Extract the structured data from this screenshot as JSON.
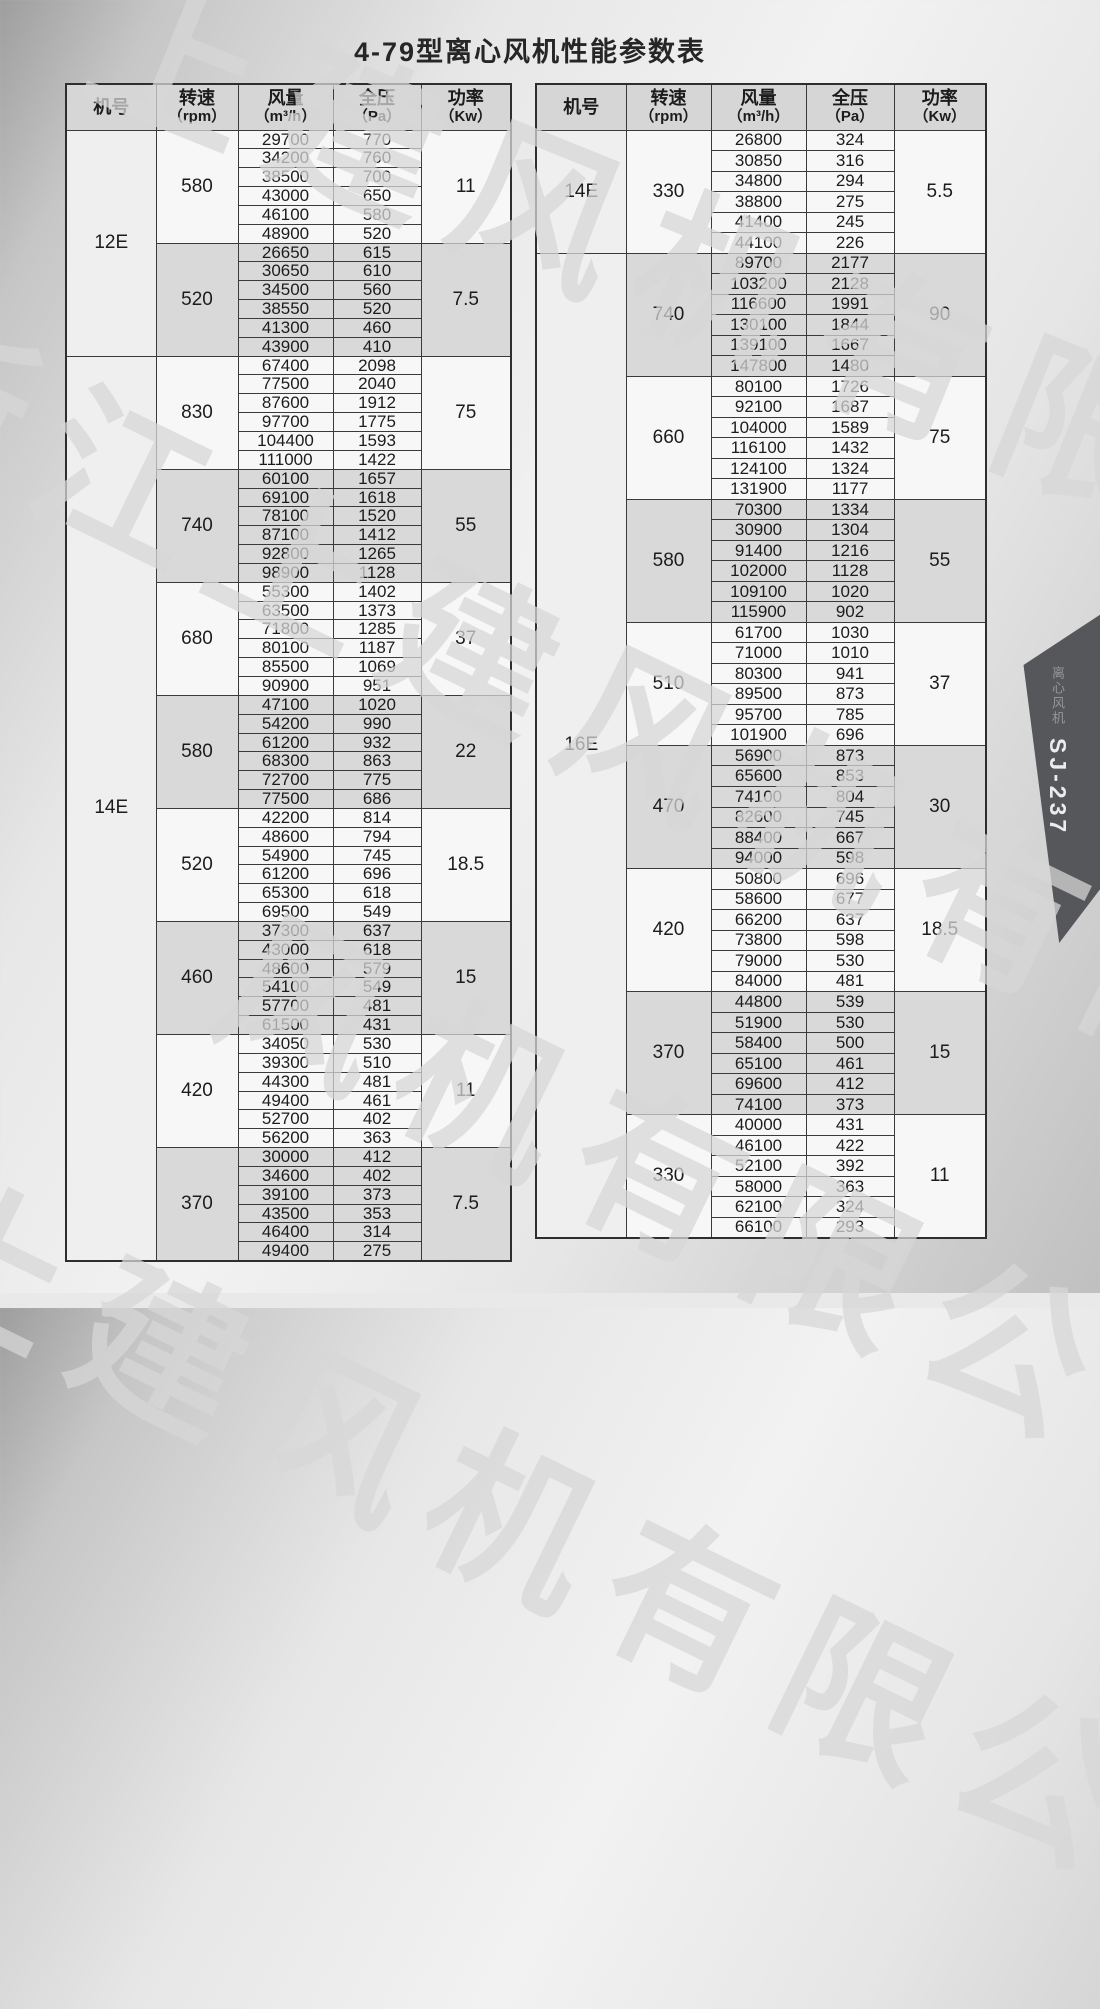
{
  "page": {
    "title": "4-79型离心风机性能参数表"
  },
  "header_labels": {
    "model": "机号",
    "speed1": "转速",
    "speed2": "（rpm）",
    "volume1": "风量",
    "volume2": "（m³/h）",
    "pressure1": "全压",
    "pressure2": "（Pa）",
    "power1": "功率",
    "power2": "（Kw）"
  },
  "tables": [
    {
      "models": [
        {
          "model": "12E",
          "groups": [
            {
              "speed": "580",
              "power": "11",
              "rows": [
                [
                  29700,
                  770
                ],
                [
                  34200,
                  760
                ],
                [
                  38500,
                  700
                ],
                [
                  43000,
                  650
                ],
                [
                  46100,
                  580
                ],
                [
                  48900,
                  520
                ]
              ]
            },
            {
              "speed": "520",
              "power": "7.5",
              "rows": [
                [
                  26650,
                  615
                ],
                [
                  30650,
                  610
                ],
                [
                  34500,
                  560
                ],
                [
                  38550,
                  520
                ],
                [
                  41300,
                  460
                ],
                [
                  43900,
                  410
                ]
              ]
            }
          ]
        },
        {
          "model": "14E",
          "groups": [
            {
              "speed": "830",
              "power": "75",
              "rows": [
                [
                  67400,
                  2098
                ],
                [
                  77500,
                  2040
                ],
                [
                  87600,
                  1912
                ],
                [
                  97700,
                  1775
                ],
                [
                  104400,
                  1593
                ],
                [
                  111000,
                  1422
                ]
              ]
            },
            {
              "speed": "740",
              "power": "55",
              "rows": [
                [
                  60100,
                  1657
                ],
                [
                  69100,
                  1618
                ],
                [
                  78100,
                  1520
                ],
                [
                  87100,
                  1412
                ],
                [
                  92800,
                  1265
                ],
                [
                  98900,
                  1128
                ]
              ]
            },
            {
              "speed": "680",
              "power": "37",
              "rows": [
                [
                  55300,
                  1402
                ],
                [
                  63500,
                  1373
                ],
                [
                  71800,
                  1285
                ],
                [
                  80100,
                  1187
                ],
                [
                  85500,
                  1069
                ],
                [
                  90900,
                  951
                ]
              ]
            },
            {
              "speed": "580",
              "power": "22",
              "rows": [
                [
                  47100,
                  1020
                ],
                [
                  54200,
                  990
                ],
                [
                  61200,
                  932
                ],
                [
                  68300,
                  863
                ],
                [
                  72700,
                  775
                ],
                [
                  77500,
                  686
                ]
              ]
            },
            {
              "speed": "520",
              "power": "18.5",
              "rows": [
                [
                  42200,
                  814
                ],
                [
                  48600,
                  794
                ],
                [
                  54900,
                  745
                ],
                [
                  61200,
                  696
                ],
                [
                  65300,
                  618
                ],
                [
                  69500,
                  549
                ]
              ]
            },
            {
              "speed": "460",
              "power": "15",
              "rows": [
                [
                  37300,
                  637
                ],
                [
                  43000,
                  618
                ],
                [
                  48600,
                  579
                ],
                [
                  54100,
                  549
                ],
                [
                  57700,
                  481
                ],
                [
                  61500,
                  431
                ]
              ]
            },
            {
              "speed": "420",
              "power": "11",
              "rows": [
                [
                  34050,
                  530
                ],
                [
                  39300,
                  510
                ],
                [
                  44300,
                  481
                ],
                [
                  49400,
                  461
                ],
                [
                  52700,
                  402
                ],
                [
                  56200,
                  363
                ]
              ]
            },
            {
              "speed": "370",
              "power": "7.5",
              "rows": [
                [
                  30000,
                  412
                ],
                [
                  34600,
                  402
                ],
                [
                  39100,
                  373
                ],
                [
                  43500,
                  353
                ],
                [
                  46400,
                  314
                ],
                [
                  49400,
                  275
                ]
              ]
            }
          ]
        }
      ]
    },
    {
      "models": [
        {
          "model": "14E",
          "groups": [
            {
              "speed": "330",
              "power": "5.5",
              "rows": [
                [
                  26800,
                  324
                ],
                [
                  30850,
                  316
                ],
                [
                  34800,
                  294
                ],
                [
                  38800,
                  275
                ],
                [
                  41400,
                  245
                ],
                [
                  44100,
                  226
                ]
              ]
            }
          ]
        },
        {
          "model": "16E",
          "groups": [
            {
              "speed": "740",
              "power": "90",
              "rows": [
                [
                  89700,
                  2177
                ],
                [
                  103200,
                  2128
                ],
                [
                  116600,
                  1991
                ],
                [
                  130100,
                  1844
                ],
                [
                  139100,
                  1667
                ],
                [
                  147800,
                  1480
                ]
              ]
            },
            {
              "speed": "660",
              "power": "75",
              "rows": [
                [
                  80100,
                  1726
                ],
                [
                  92100,
                  1687
                ],
                [
                  104000,
                  1589
                ],
                [
                  116100,
                  1432
                ],
                [
                  124100,
                  1324
                ],
                [
                  131900,
                  1177
                ]
              ]
            },
            {
              "speed": "580",
              "power": "55",
              "rows": [
                [
                  70300,
                  1334
                ],
                [
                  30900,
                  1304
                ],
                [
                  91400,
                  1216
                ],
                [
                  102000,
                  1128
                ],
                [
                  109100,
                  1020
                ],
                [
                  115900,
                  902
                ]
              ]
            },
            {
              "speed": "510",
              "power": "37",
              "rows": [
                [
                  61700,
                  1030
                ],
                [
                  71000,
                  1010
                ],
                [
                  80300,
                  941
                ],
                [
                  89500,
                  873
                ],
                [
                  95700,
                  785
                ],
                [
                  101900,
                  696
                ]
              ]
            },
            {
              "speed": "470",
              "power": "30",
              "rows": [
                [
                  56900,
                  873
                ],
                [
                  65600,
                  853
                ],
                [
                  74100,
                  804
                ],
                [
                  82600,
                  745
                ],
                [
                  88400,
                  667
                ],
                [
                  94000,
                  598
                ]
              ]
            },
            {
              "speed": "420",
              "power": "18.5",
              "rows": [
                [
                  50800,
                  696
                ],
                [
                  58600,
                  677
                ],
                [
                  66200,
                  637
                ],
                [
                  73800,
                  598
                ],
                [
                  79000,
                  530
                ],
                [
                  84000,
                  481
                ]
              ]
            },
            {
              "speed": "370",
              "power": "15",
              "rows": [
                [
                  44800,
                  539
                ],
                [
                  51900,
                  530
                ],
                [
                  58400,
                  500
                ],
                [
                  65100,
                  461
                ],
                [
                  69600,
                  412
                ],
                [
                  74100,
                  373
                ]
              ]
            },
            {
              "speed": "330",
              "power": "11",
              "rows": [
                [
                  40000,
                  431
                ],
                [
                  46100,
                  422
                ],
                [
                  52100,
                  392
                ],
                [
                  58000,
                  363
                ],
                [
                  62100,
                  324
                ],
                [
                  66100,
                  293
                ]
              ]
            }
          ]
        }
      ]
    }
  ],
  "watermarks": [
    {
      "text": "上建风机有限公司",
      "left": 150,
      "top": -90,
      "angle": 22,
      "size": 165
    },
    {
      "text": "浙江上建风机有限公司",
      "left": -70,
      "top": 240,
      "angle": 26,
      "size": 165
    },
    {
      "text": "风机有限公司",
      "left": 290,
      "top": 850,
      "angle": 26,
      "size": 165
    },
    {
      "text": "上建风机有限公司",
      "left": -30,
      "top": 1110,
      "angle": 26,
      "size": 165
    }
  ],
  "side_tab": {
    "vertical_label": "离心风机",
    "code": "SJ-237"
  }
}
